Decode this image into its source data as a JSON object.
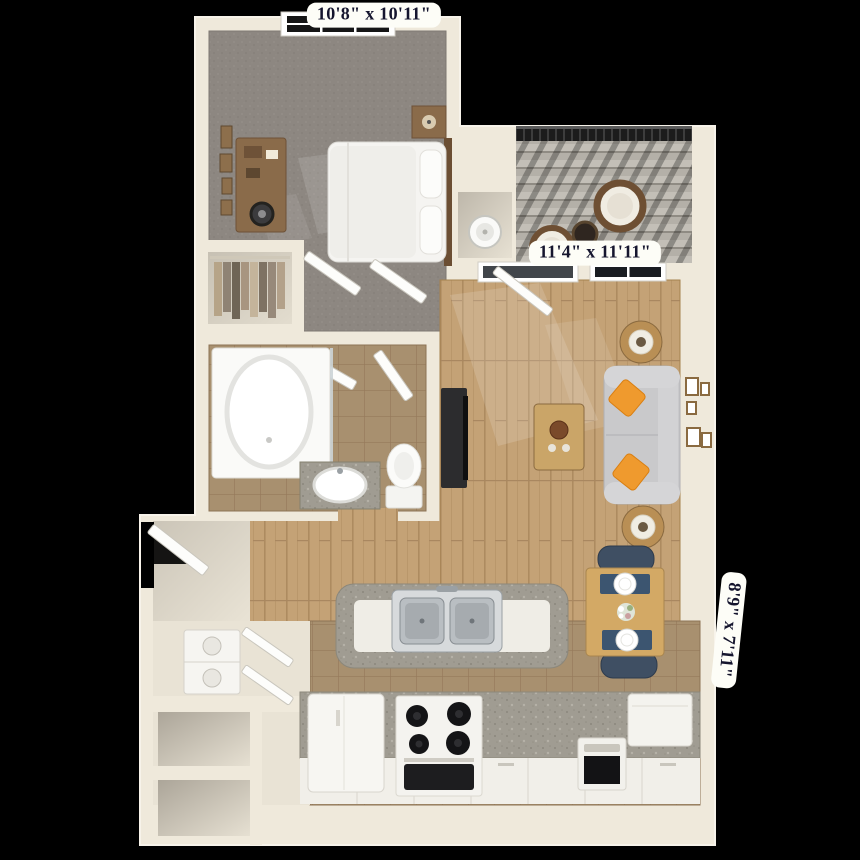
{
  "scene": {
    "description": "3D rendered top-down floor plan of a one-bedroom apartment on a black background",
    "background_color": "#000000"
  },
  "dimension_labels": {
    "bedroom": "10'8\" x 10'11\"",
    "living_room": "11'4\" x 11'11\"",
    "patio": "8'9\" x 7'11\""
  },
  "rooms": [
    {
      "name": "bedroom",
      "dimensions": "10'8\" x 10'11\""
    },
    {
      "name": "living-room",
      "dimensions": "11'4\" x 11'11\""
    },
    {
      "name": "patio-balcony",
      "dimensions": "8'9\" x 7'11\""
    },
    {
      "name": "bathroom"
    },
    {
      "name": "walk-in-closet"
    },
    {
      "name": "kitchen"
    },
    {
      "name": "dining-area"
    },
    {
      "name": "laundry-closet"
    },
    {
      "name": "entry"
    },
    {
      "name": "storage-closets"
    },
    {
      "name": "water-heater-closet"
    }
  ],
  "colors": {
    "wall": "#efe9db",
    "carpet": "#8d8781",
    "hardwood": "#c4a276",
    "tile": "#a8906f",
    "granite": "#a09c92",
    "sofa": "#c9c9cb",
    "accent_pillow": "#ef9a2e",
    "dining_chair": "#3f4f63",
    "deck": "#b4b0a8",
    "label_background": "#fdfdf7",
    "label_text": "#15152e"
  }
}
